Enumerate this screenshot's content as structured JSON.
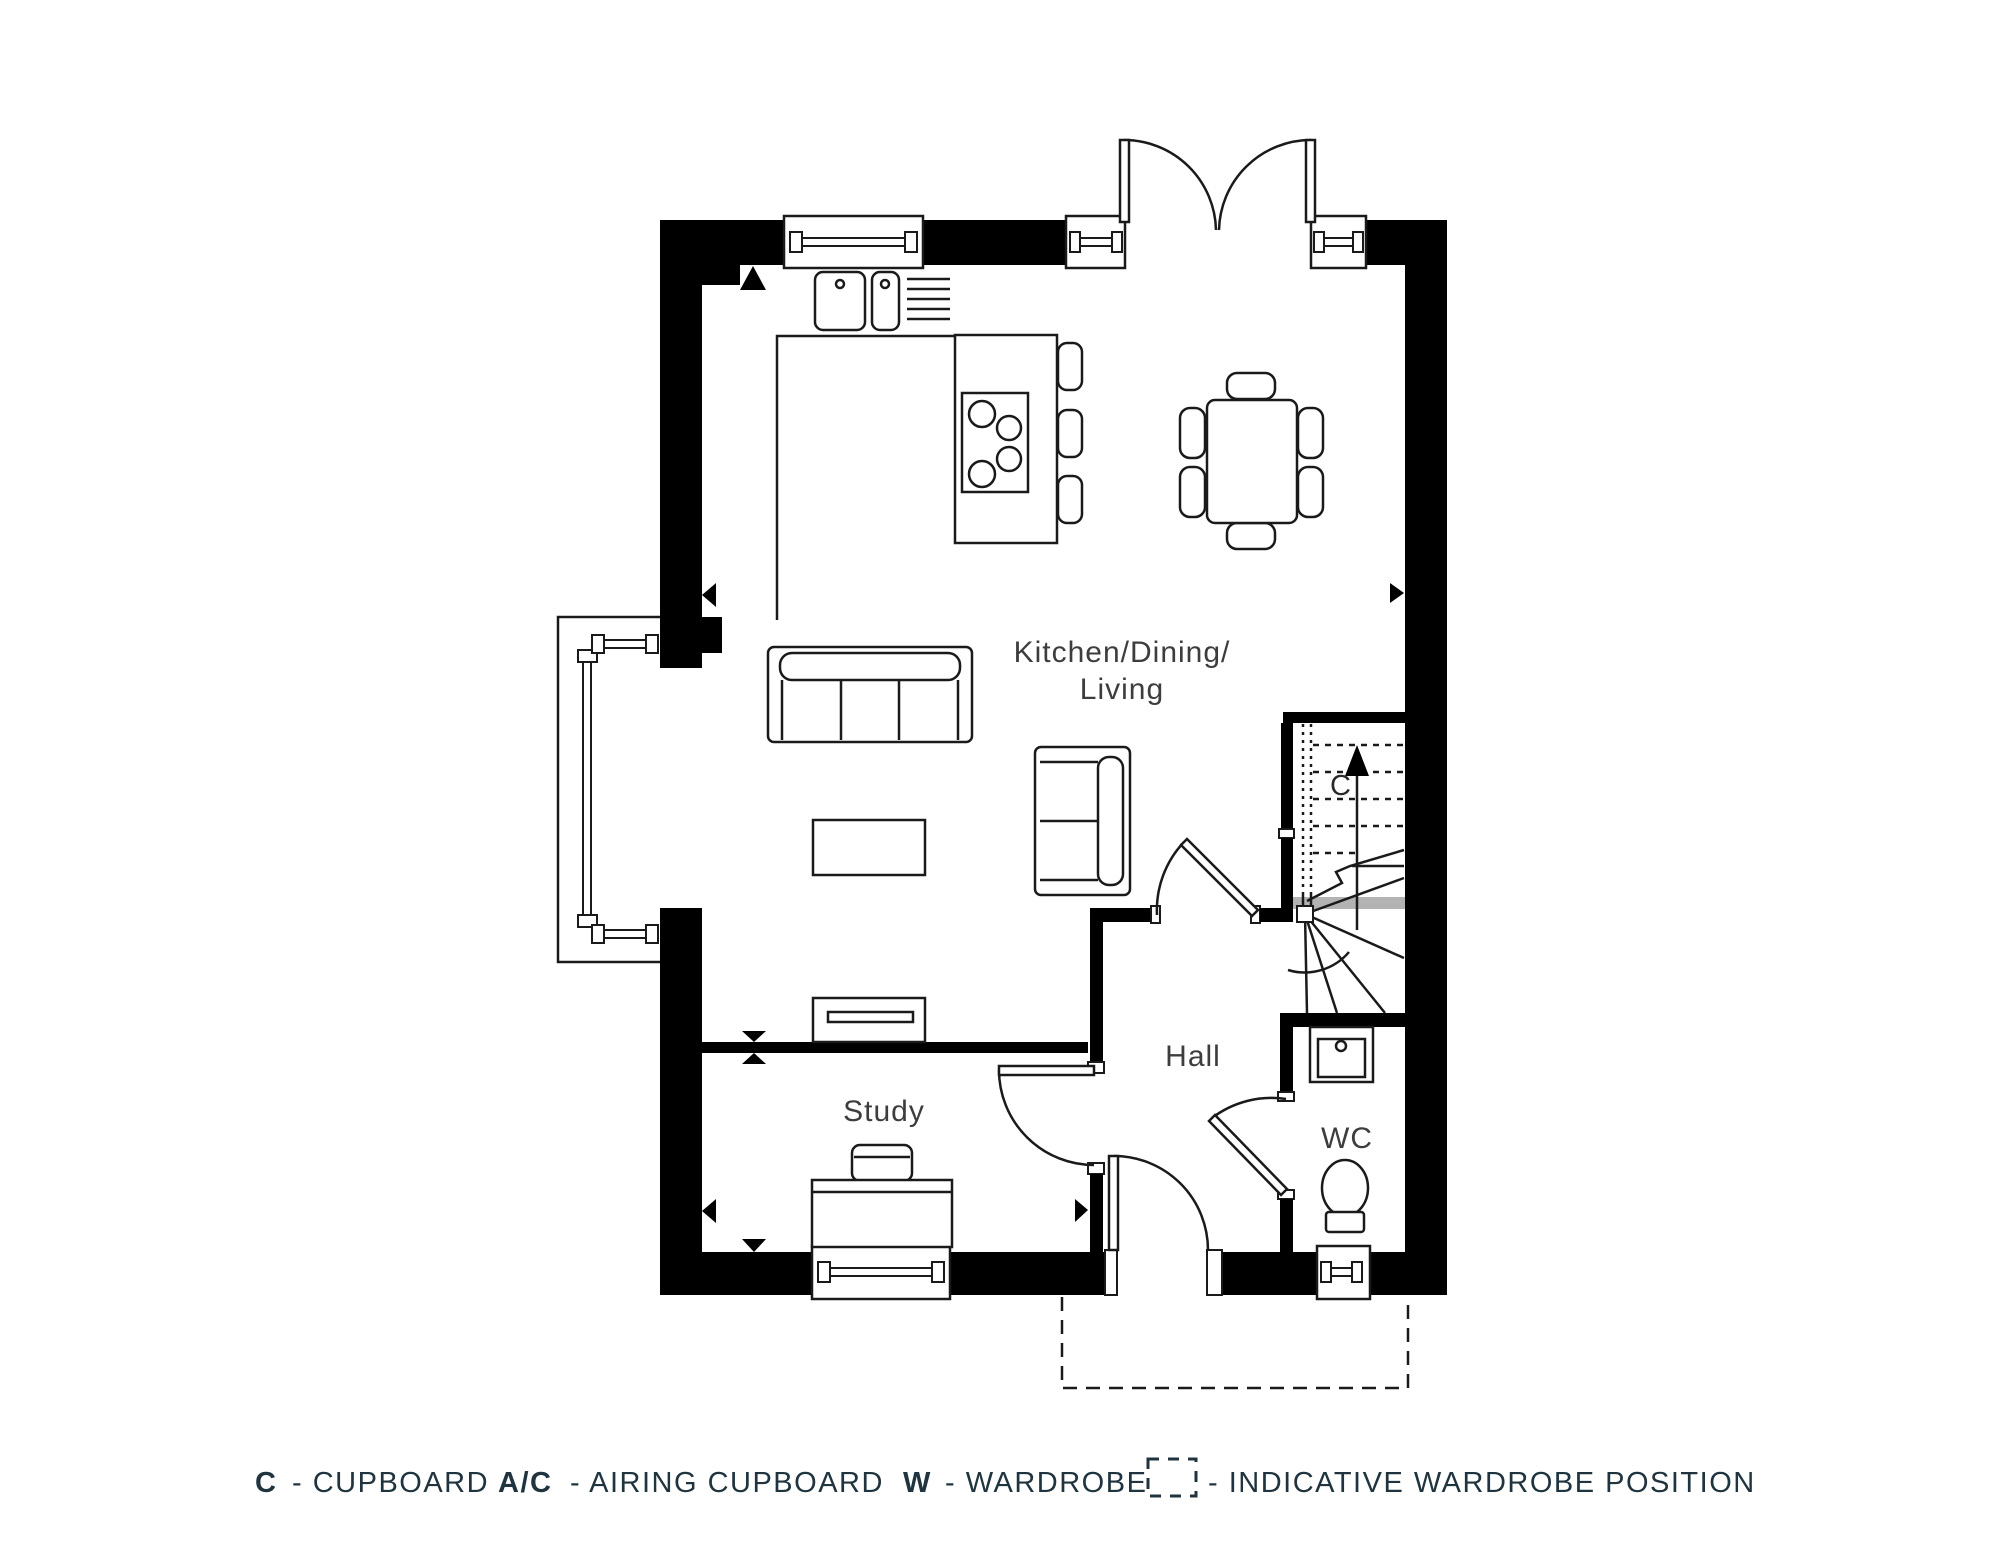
{
  "plan": {
    "rooms": {
      "kitchen_dining_living": {
        "line1": "Kitchen/Dining/",
        "line2": "Living"
      },
      "hall": {
        "label": "Hall"
      },
      "study": {
        "label": "Study"
      },
      "wc": {
        "label": "WC"
      },
      "stairs": {
        "cupboard_label": "C"
      }
    }
  },
  "legend": {
    "items": [
      {
        "symbol": "C",
        "label": "- CUPBOARD"
      },
      {
        "symbol": "A/C",
        "label": "- AIRING CUPBOARD"
      },
      {
        "symbol": "W",
        "label": "- WARDROBE"
      },
      {
        "symbol": "indicative-wardrobe-dashed-box",
        "label": "- INDICATIVE WARDROBE POSITION"
      }
    ]
  },
  "colors": {
    "line": "#000000",
    "legend_text": "#20343f",
    "room_text": "#3d3d3d",
    "landing_strip": "#b3b3b3",
    "background": "#ffffff"
  }
}
